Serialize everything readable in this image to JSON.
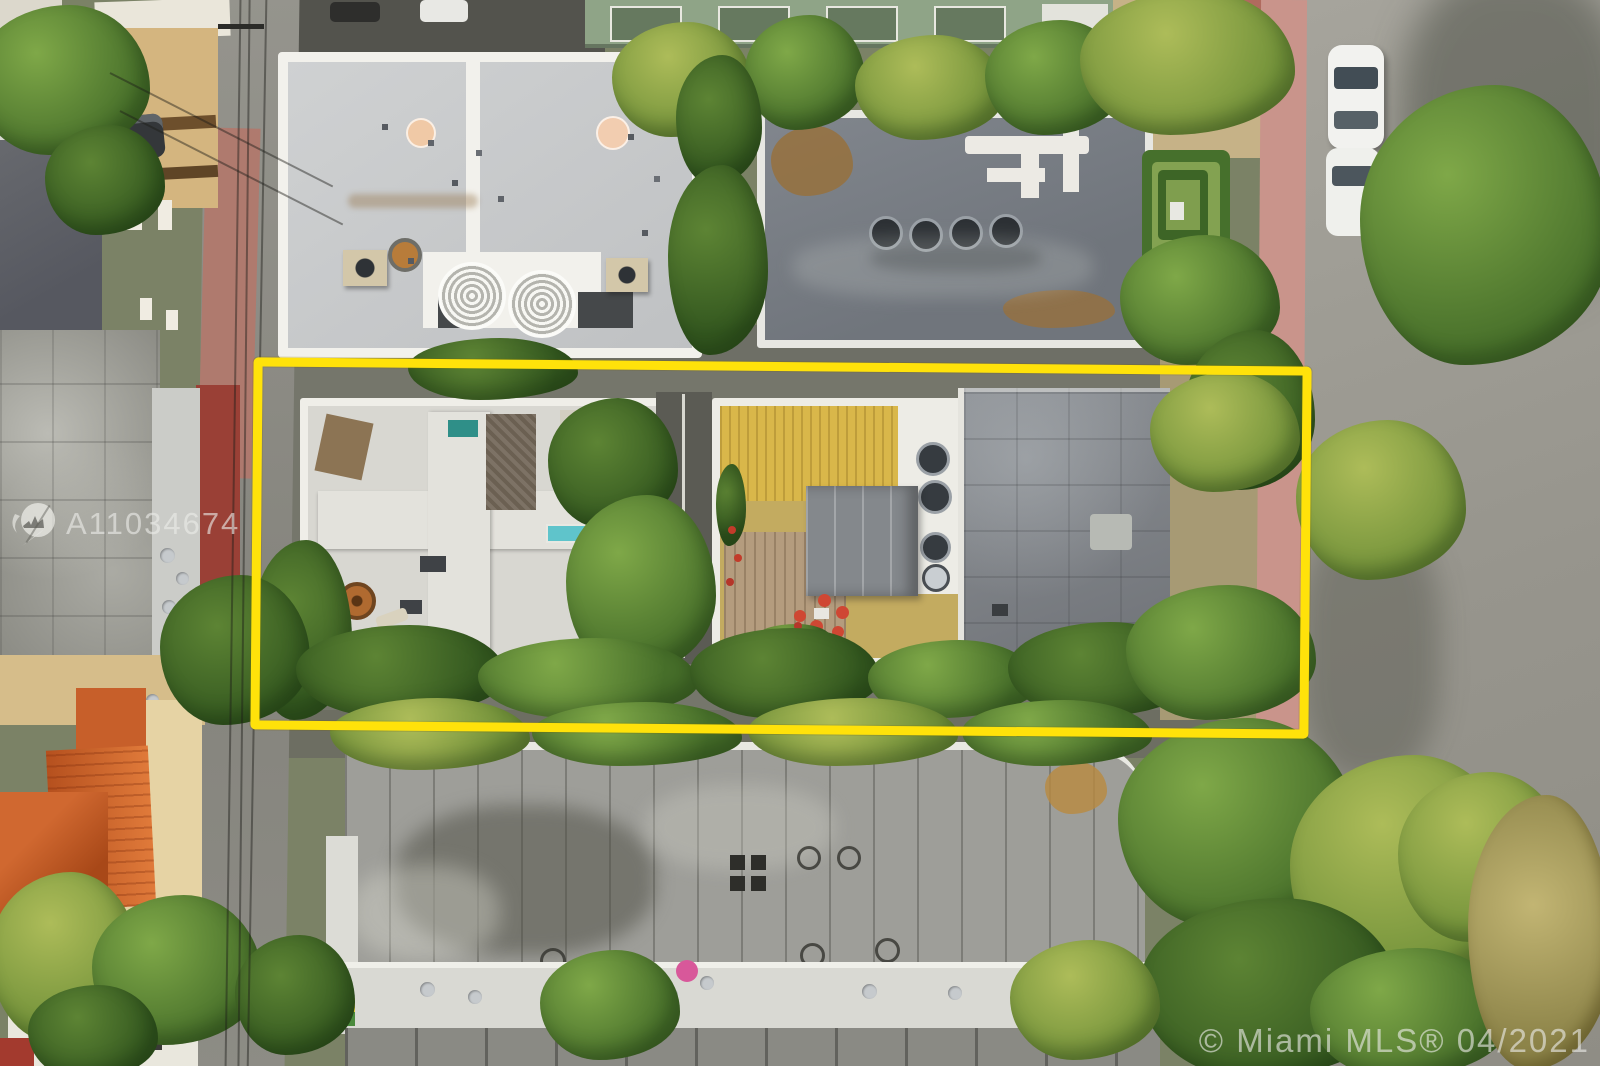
{
  "watermarks": {
    "listing_id": "A11034674",
    "copyright_line": "© Miami MLS® 04/2021"
  },
  "property_outline": {
    "color": "#FFE20A"
  },
  "scene": {
    "kind": "aerial-photo"
  }
}
